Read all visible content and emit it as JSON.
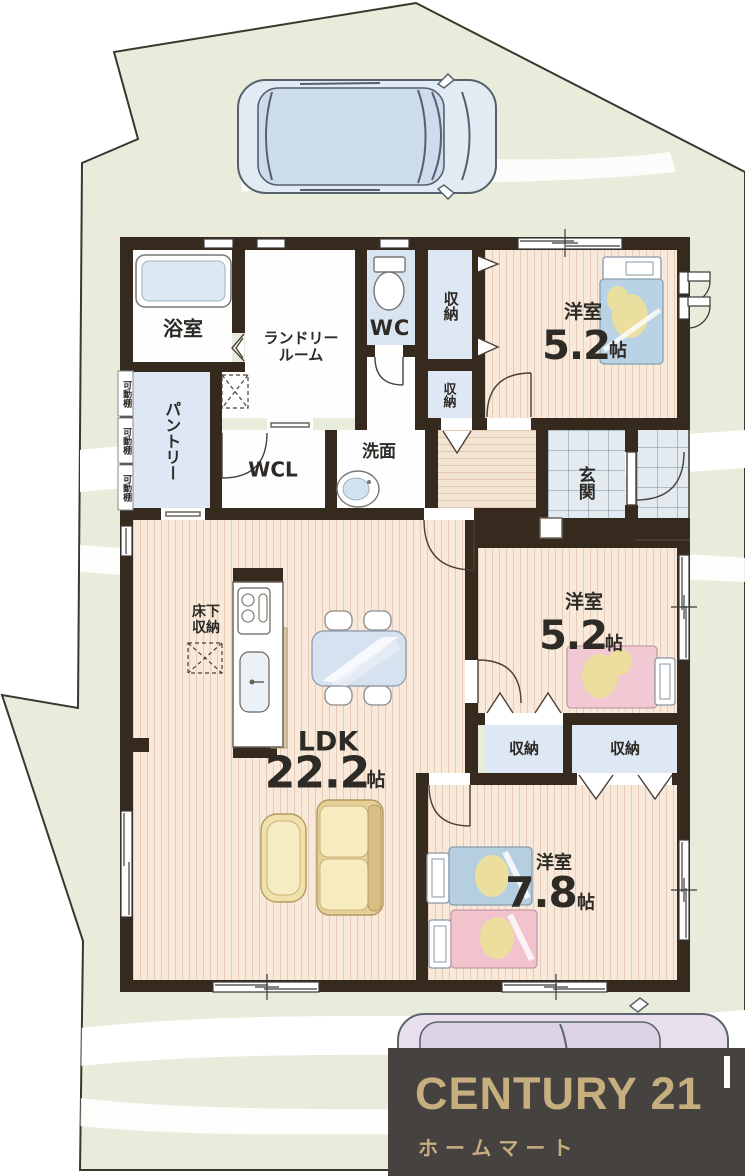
{
  "site": {
    "ground_color": "#e9ecda",
    "boundary_color": "#3b372e",
    "vehicles": [
      "parked-car-top-view",
      "parked-car-bottom-partial"
    ]
  },
  "plan": {
    "wall_color": "#36291e",
    "wood_color": "#f8e9da",
    "tile_color": "#e3ebf1",
    "closet_color": "#dde8f4",
    "rooms": {
      "bath": {
        "label": "浴室"
      },
      "laundry": {
        "line1": "ランドリー",
        "line2": "ルーム"
      },
      "wc": {
        "label": "WC"
      },
      "wcl": {
        "label": "WCL"
      },
      "pantry": {
        "label": "パントリー"
      },
      "washroom": {
        "label": "洗面"
      },
      "entrance": {
        "label": "玄関"
      },
      "storage": {
        "label": "収納"
      },
      "bedroom1": {
        "label": "洋室",
        "size": "5.2",
        "unit": "帖"
      },
      "bedroom2": {
        "label": "洋室",
        "size": "5.2",
        "unit": "帖"
      },
      "bedroom3": {
        "label": "洋室",
        "size": "7.8",
        "unit": "帖"
      },
      "ldk": {
        "label": "LDK",
        "size": "22.2",
        "unit": "帖"
      },
      "underfloor": {
        "line1": "床下",
        "line2": "収納"
      },
      "shelf": {
        "label": "可動棚"
      }
    },
    "furniture": [
      "bathtub",
      "toilet",
      "washbasin",
      "kitchen-counter",
      "dining-table",
      "chairs",
      "sofa",
      "armchair",
      "single-bed-blue",
      "single-bed-pink",
      "double-bed-blue-pink"
    ]
  },
  "logo": {
    "brand": "CENTURY 21",
    "store": "ホームマート",
    "bg_color": "#454240",
    "text_color": "#c7ae7e"
  }
}
